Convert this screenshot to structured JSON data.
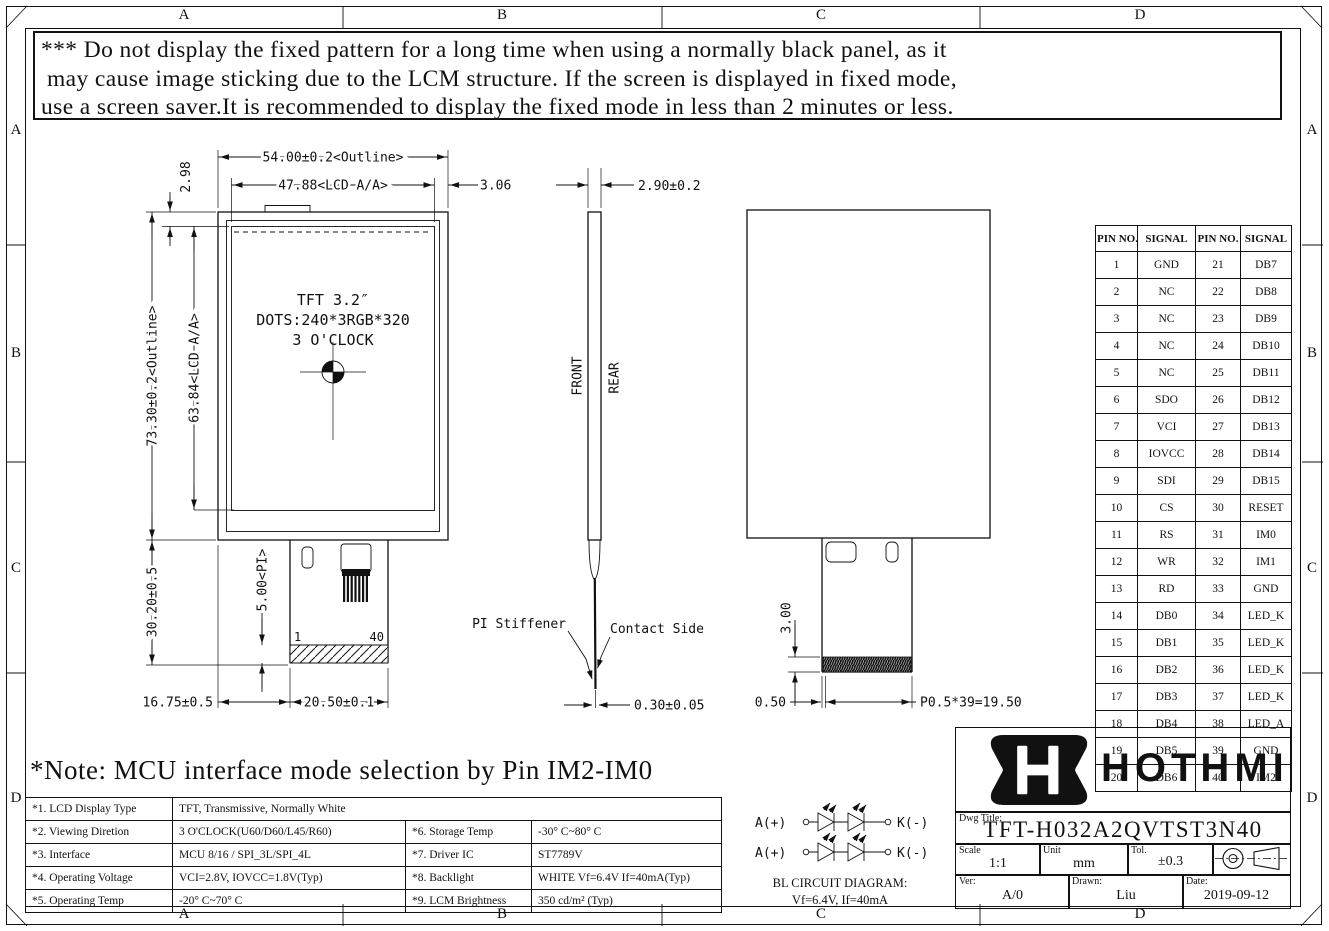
{
  "zones": [
    "A",
    "B",
    "C",
    "D"
  ],
  "warning": {
    "line1": "*** Do not display the fixed pattern for a long time when using a normally black panel, as it",
    "line2": "may cause image sticking due to the LCM structure. If the screen is displayed in fixed mode,",
    "line3": "use a screen saver.It is recommended to display the fixed mode in less than 2 minutes or less."
  },
  "note": "*Note: MCU interface mode selection by Pin IM2-IM0",
  "front_view": {
    "panel_line1": "TFT 3.2″",
    "panel_line2": "DOTS:240*3RGB*320",
    "panel_line3": "3 O'CLOCK",
    "fpc_pin_first": "1",
    "fpc_pin_last": "40",
    "dims": {
      "outline_width": "54.00±0.2<Outline>",
      "aa_width": "47.88<LCD A/A>",
      "right_margin": "3.06",
      "top_margin": "2.98",
      "outline_height": "73.30±0.2<Outline>",
      "aa_height": "63.84<LCD A/A>",
      "fpc_drop": "30.20±0.5",
      "pi_length": "5.00<PI>",
      "fpc_offset": "16.75±0.5",
      "fpc_width": "20.50±0.1"
    }
  },
  "side_view": {
    "front_label": "FRONT",
    "rear_label": "REAR",
    "pi_stiffener_label": "PI Stiffener",
    "contact_side_label": "Contact Side",
    "dims": {
      "thickness": "2.90±0.2",
      "fpc_thickness": "0.30±0.05"
    }
  },
  "rear_view": {
    "dims": {
      "contact_height": "3.00",
      "edge_margin": "0.50",
      "pad_pitch": "P0.5*39=19.50"
    }
  },
  "bl_circuit": {
    "anode_label": "A(+)",
    "cathode_label": "K(-)",
    "title": "BL CIRCUIT DIAGRAM:",
    "spec": "Vf=6.4V, If=40mA"
  },
  "pin_table": {
    "headers": [
      "PIN NO.",
      "SIGNAL",
      "PIN NO.",
      "SIGNAL"
    ],
    "rows": [
      [
        "1",
        "GND",
        "21",
        "DB7"
      ],
      [
        "2",
        "NC",
        "22",
        "DB8"
      ],
      [
        "3",
        "NC",
        "23",
        "DB9"
      ],
      [
        "4",
        "NC",
        "24",
        "DB10"
      ],
      [
        "5",
        "NC",
        "25",
        "DB11"
      ],
      [
        "6",
        "SDO",
        "26",
        "DB12"
      ],
      [
        "7",
        "VCI",
        "27",
        "DB13"
      ],
      [
        "8",
        "IOVCC",
        "28",
        "DB14"
      ],
      [
        "9",
        "SDI",
        "29",
        "DB15"
      ],
      [
        "10",
        "CS",
        "30",
        "RESET"
      ],
      [
        "11",
        "RS",
        "31",
        "IM0"
      ],
      [
        "12",
        "WR",
        "32",
        "IM1"
      ],
      [
        "13",
        "RD",
        "33",
        "GND"
      ],
      [
        "14",
        "DB0",
        "34",
        "LED_K"
      ],
      [
        "15",
        "DB1",
        "35",
        "LED_K"
      ],
      [
        "16",
        "DB2",
        "36",
        "LED_K"
      ],
      [
        "17",
        "DB3",
        "37",
        "LED_K"
      ],
      [
        "18",
        "DB4",
        "38",
        "LED_A"
      ],
      [
        "19",
        "DB5",
        "39",
        "GND"
      ],
      [
        "20",
        "DB6",
        "40",
        "IM2"
      ]
    ]
  },
  "spec_table": {
    "rows": [
      [
        "*1. LCD Display Type",
        "TFT, Transmissive, Normally White"
      ],
      [
        "*2. Viewing Diretion",
        "3 O'CLOCK(U60/D60/L45/R60)",
        "*6. Storage Temp",
        "-30° C~80° C"
      ],
      [
        "*3. Interface",
        "MCU 8/16 / SPI_3L/SPI_4L",
        "*7. Driver IC",
        "ST7789V"
      ],
      [
        "*4. Operating Voltage",
        "VCI=2.8V, IOVCC=1.8V(Typ)",
        "*8. Backlight",
        "WHITE Vf=6.4V If=40mA(Typ)"
      ],
      [
        "*5. Operating Temp",
        "-20° C~70° C",
        "*9. LCM Brightness",
        "350 cd/m² (Typ)"
      ]
    ]
  },
  "title_block": {
    "brand": "HOTHMI",
    "dwg_title_label": "Dwg Title:",
    "dwg_title": "TFT-H032A2QVTST3N40",
    "scale_label": "Scale",
    "scale": "1:1",
    "unit_label": "Unit",
    "unit": "mm",
    "tol_label": "Tol.",
    "tol": "±0.3",
    "ver_label": "Ver:",
    "ver": "A/0",
    "drawn_label": "Drawn:",
    "drawn": "Liu",
    "date_label": "Date:",
    "date": "2019-09-12"
  }
}
